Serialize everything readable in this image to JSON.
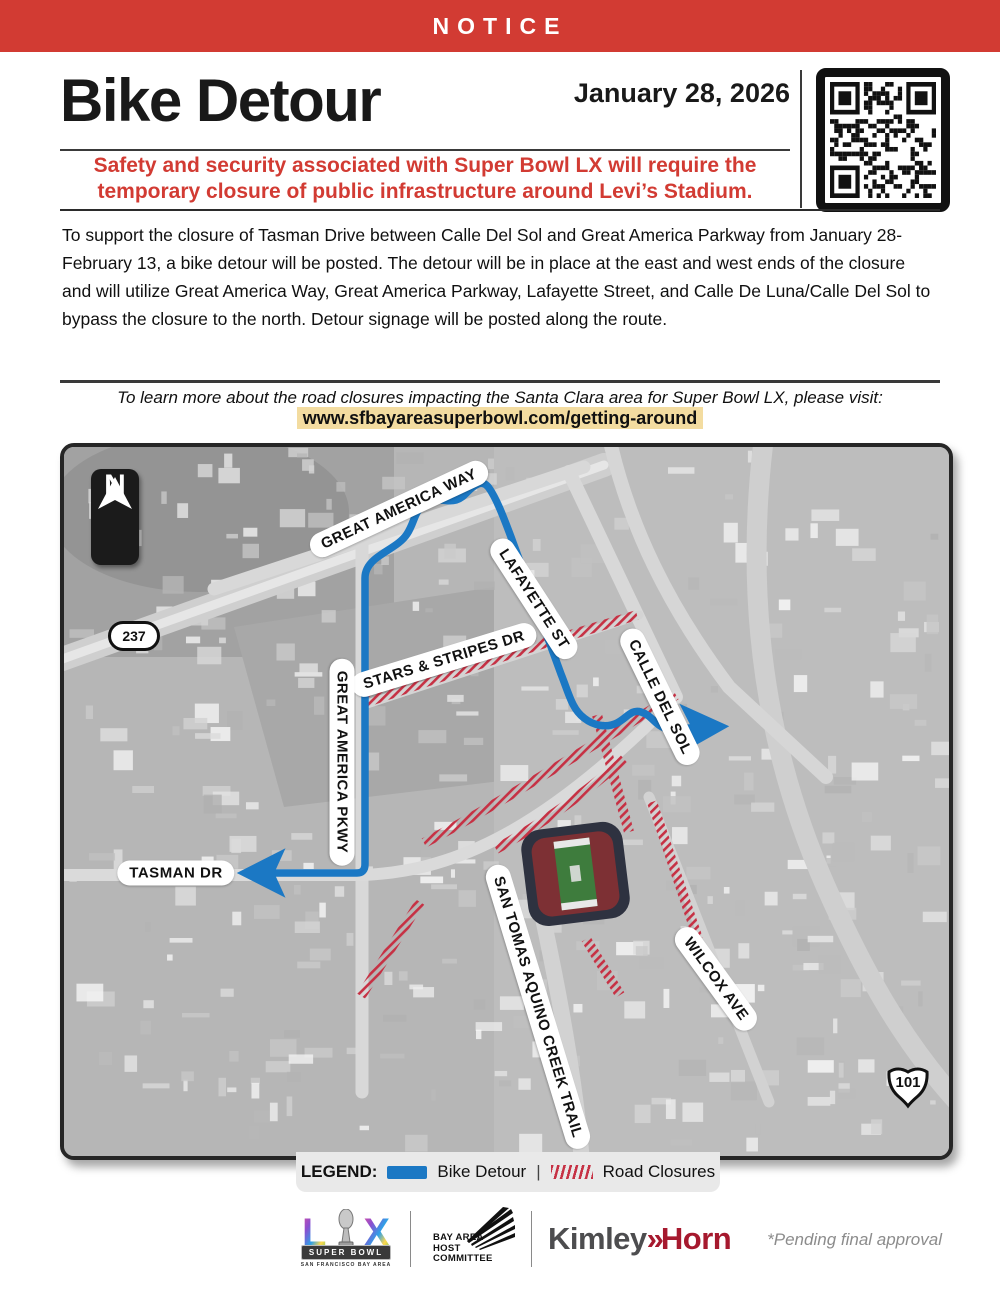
{
  "colors": {
    "accent_red": "#D23B33",
    "route_blue": "#1B78C4",
    "closure_red": "#C63144",
    "url_highlight": "#F3DCA0"
  },
  "banner": {
    "label": "NOTICE"
  },
  "header": {
    "title": "Bike Detour",
    "date": "January 28, 2026",
    "qr": "qr-code"
  },
  "alert": {
    "line1": "Safety and security associated with Super Bowl LX will require the",
    "line2": "temporary closure of public infrastructure around Levi’s Stadium."
  },
  "body": {
    "paragraph": "To support the closure of Tasman Drive between Calle Del Sol and Great America Parkway from January 28-February 13, a bike detour will be posted. The detour will be in place at the east and west ends of the closure and will utilize Great America Way, Great America Parkway, Lafayette Street, and Calle De Luna/Calle Del Sol to bypass the closure to the north. Detour signage will be posted along the route."
  },
  "learn_more": {
    "text": "To learn more about the road closures impacting the Santa Clara area for Super Bowl LX, please visit:",
    "url": "www.sfbayareasuperbowl.com/getting-around"
  },
  "map": {
    "north_label": "N",
    "shields": [
      {
        "text": "237"
      },
      {
        "text": "101"
      }
    ],
    "road_labels": [
      {
        "text": "GREAT AMERICA WAY",
        "x": 335,
        "y": 62,
        "rot": -25
      },
      {
        "text": "LAFAYETTE ST",
        "x": 470,
        "y": 152,
        "rot": 57
      },
      {
        "text": "STARS & STRIPES DR",
        "x": 380,
        "y": 213,
        "rot": -17
      },
      {
        "text": "CALLE DEL SOL",
        "x": 596,
        "y": 250,
        "rot": 64
      },
      {
        "text": "GREAT AMERICA PKWY",
        "x": 278,
        "y": 315,
        "rot": 90
      },
      {
        "text": "TASMAN DR",
        "x": 112,
        "y": 426,
        "rot": 0
      },
      {
        "text": "SAN TOMAS AQUINO CREEK TRAIL",
        "x": 474,
        "y": 560,
        "rot": 73
      },
      {
        "text": "WILCOX AVE",
        "x": 652,
        "y": 532,
        "rot": 54
      }
    ]
  },
  "legend": {
    "title": "LEGEND:",
    "bike_detour": "Bike Detour",
    "separator": "|",
    "road_closures": "Road Closures"
  },
  "footer": {
    "superbowl": {
      "letter_l": "L",
      "letter_x": "X",
      "banner": "SUPER BOWL",
      "subtext": "SAN FRANCISCO BAY AREA"
    },
    "host_committee": [
      "BAY AREA",
      "HOST",
      "COMMITTEE"
    ],
    "kimley": {
      "word1": "Kimley",
      "chevrons": "»",
      "word2": "Horn"
    },
    "pending_note": "*Pending final approval"
  }
}
